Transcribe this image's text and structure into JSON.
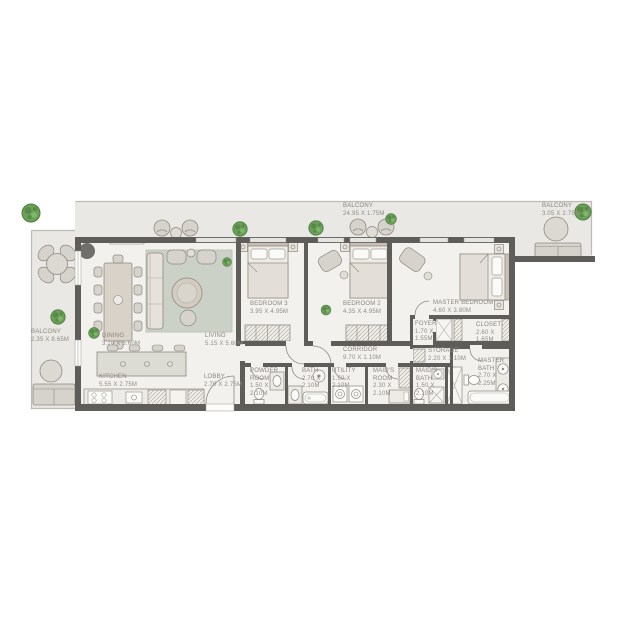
{
  "rooms": {
    "balcony_left": {
      "name": "BALCONY",
      "dims": "2.35 X 8.65M"
    },
    "balcony_top": {
      "name": "BALCONY",
      "dims": "24.95 X 1.75M"
    },
    "balcony_right": {
      "name": "BALCONY",
      "dims": "3.05 X 2.75M"
    },
    "dining": {
      "name": "DINING",
      "dims": "3.10 X 5.60M"
    },
    "living": {
      "name": "LIVING",
      "dims": "5.15 X 5.60M"
    },
    "kitchen": {
      "name": "KITCHEN",
      "dims": "5.55 X 2.75M"
    },
    "lobby": {
      "name": "LOBBY",
      "dims": "2.70 X 2.75M"
    },
    "bedroom3": {
      "name": "BEDROOM 3",
      "dims": "3.95 X 4.95M"
    },
    "bedroom2": {
      "name": "BEDROOM 2",
      "dims": "4.35 X 4.95M"
    },
    "master_bedroom": {
      "name": "MASTER BEDROOM",
      "dims": "4.60 X 3.80M"
    },
    "foyer": {
      "name": "FOYER",
      "dims": "1.70 X 1.55M"
    },
    "closet": {
      "name": "CLOSET",
      "dims": "2.60 X 1.65M"
    },
    "storage": {
      "name": "STORAGE",
      "dims": "2.20 X 1.10M"
    },
    "corridor": {
      "name": "CORRIDOR",
      "dims": "9.70 X 1.10M"
    },
    "powder_room": {
      "name": "POWDER ROOM",
      "dims": "1.50 X 2.10M"
    },
    "bath": {
      "name": "BATH",
      "dims": "2.70 X 2.10M"
    },
    "utility": {
      "name": "UTILITY",
      "dims": "1.50 X 2.10M"
    },
    "maids_room": {
      "name": "MAID'S ROOM",
      "dims": "2.30 X 2.10M"
    },
    "maids_bath": {
      "name": "MAID'S BATH",
      "dims": "1.50 X 2.10M"
    },
    "master_bath": {
      "name": "MASTER BATH",
      "dims": "2.70 X 2.25M"
    }
  },
  "icons": [
    "tree-icon",
    "plant-icon"
  ],
  "colors": {
    "wall": "#5e5d5a",
    "interior_floor": "#f2f1ee",
    "balcony_floor": "#e9e8e4",
    "furniture": "#d6d3cc",
    "rug": "#ccd1c7",
    "tree_green": "#6ca05a",
    "label_text": "#8b867f"
  }
}
